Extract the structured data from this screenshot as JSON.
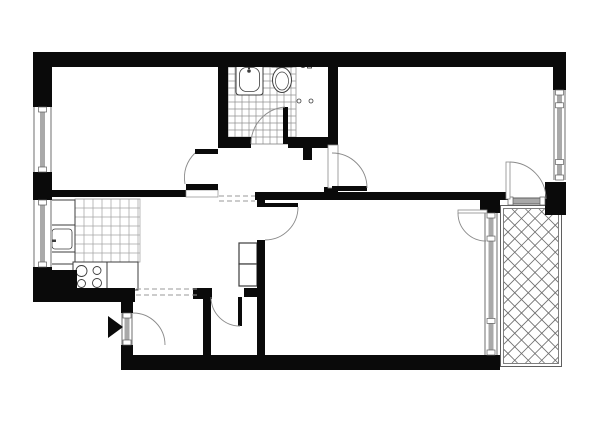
{
  "canvas": {
    "width": 600,
    "height": 424,
    "background": "#ffffff"
  },
  "colors": {
    "wall": "#0a0a0a",
    "glazing": "#a9a9a9",
    "line": "#5f5f5f",
    "arc": "#8a8a8a",
    "tile": "#a5a5a5",
    "bathtile": "#909090",
    "hatch": "#6e6e6e",
    "dash": "#9a9a9a",
    "fixture": "#3d3d3d",
    "white": "#ffffff"
  },
  "rooms": [
    {
      "name": "room-top-left-area",
      "x": 52,
      "y": 67,
      "w": 166,
      "h": 123
    },
    {
      "name": "bedroom-area",
      "x": 338,
      "y": 67,
      "w": 215,
      "h": 125
    },
    {
      "name": "bathroom-area",
      "x": 228,
      "y": 67,
      "w": 100,
      "h": 70
    },
    {
      "name": "kitchen-area",
      "x": 48,
      "y": 197,
      "w": 92,
      "h": 93
    },
    {
      "name": "corridor-area",
      "x": 140,
      "y": 197,
      "w": 117,
      "h": 91
    },
    {
      "name": "living-room-area",
      "x": 265,
      "y": 200,
      "w": 220,
      "h": 155
    },
    {
      "name": "entry-hall-area",
      "x": 133,
      "y": 297,
      "w": 70,
      "h": 58
    },
    {
      "name": "storage-room-area",
      "x": 211,
      "y": 297,
      "w": 46,
      "h": 58
    },
    {
      "name": "balcony-area",
      "x": 500,
      "y": 205,
      "w": 62,
      "h": 162
    }
  ],
  "shapes": [
    {
      "name": "kitchen-floor-tiles",
      "type": "grid",
      "x": 75,
      "y": 199,
      "w": 65,
      "h": 63,
      "cell": 9,
      "stroke": "tile",
      "sw": 0.75
    },
    {
      "name": "bathroom-floor-tiles",
      "type": "grid",
      "x": 228,
      "y": 67,
      "w": 68,
      "h": 77,
      "cell": 7,
      "stroke": "bathtile",
      "sw": 0.7
    },
    {
      "name": "balcony-border-outer",
      "type": "rectline",
      "x": 500.5,
      "y": 205.5,
      "w": 61,
      "h": 161,
      "stroke": "line",
      "sw": 1
    },
    {
      "name": "balcony-border-inner",
      "type": "rectline",
      "x": 503.5,
      "y": 208.5,
      "w": 55,
      "h": 155,
      "stroke": "line",
      "sw": 0.8
    },
    {
      "name": "balcony-decking-hatch",
      "type": "hatch",
      "x": 504,
      "y": 209,
      "w": 54,
      "h": 154,
      "spacing": 13.5,
      "stroke": "hatch",
      "sw": 0.8
    },
    {
      "name": "bathtub-outer",
      "type": "rect",
      "x": 236,
      "y": 64,
      "w": 27,
      "h": 31,
      "rx": 3,
      "fill": "white",
      "stroke": "fixture",
      "sw": 1
    },
    {
      "name": "bathtub-inner",
      "type": "rect",
      "x": 239.5,
      "y": 67.5,
      "w": 20,
      "h": 24,
      "rx": 7,
      "fill": "none",
      "stroke": "fixture",
      "sw": 0.8
    },
    {
      "name": "bathtub-faucet-icon",
      "type": "circle",
      "cx": 249,
      "cy": 71,
      "r": 1.8,
      "fill": "fixture",
      "stroke": "none"
    },
    {
      "name": "bathtub-faucet-stem",
      "type": "rect",
      "x": 248,
      "y": 64,
      "w": 2,
      "h": 5,
      "fill": "fixture",
      "stroke": "none"
    },
    {
      "name": "toilet-tank",
      "type": "rect",
      "x": 272,
      "y": 61,
      "w": 20,
      "h": 6,
      "fill": "white",
      "stroke": "fixture",
      "sw": 1
    },
    {
      "name": "toilet-bowl",
      "type": "ellipse",
      "cx": 282,
      "cy": 80,
      "rx": 9.5,
      "ry": 12.5,
      "fill": "white",
      "stroke": "fixture",
      "sw": 1
    },
    {
      "name": "toilet-bowl-inner",
      "type": "ellipse",
      "cx": 282,
      "cy": 81,
      "rx": 6.5,
      "ry": 9,
      "fill": "none",
      "stroke": "fixture",
      "sw": 0.7
    },
    {
      "name": "utility-tap-icon",
      "type": "circle",
      "cx": 303,
      "cy": 65,
      "r": 2.6,
      "fill": "none",
      "stroke": "fixture",
      "sw": 0.9
    },
    {
      "name": "utility-valve-icon",
      "type": "rect",
      "x": 307.5,
      "y": 59,
      "w": 4,
      "h": 9,
      "fill": "white",
      "stroke": "fixture",
      "sw": 0.9
    },
    {
      "name": "hookup-point-left",
      "type": "circle",
      "cx": 299,
      "cy": 101,
      "r": 2,
      "fill": "none",
      "stroke": "fixture",
      "sw": 0.8
    },
    {
      "name": "hookup-point-right",
      "type": "circle",
      "cx": 311,
      "cy": 101,
      "r": 2,
      "fill": "none",
      "stroke": "fixture",
      "sw": 0.8
    },
    {
      "name": "bathroom-zone-divider",
      "type": "line",
      "x1": 296,
      "y1": 67,
      "x2": 296,
      "y2": 142,
      "stroke": "tile",
      "sw": 0.8
    },
    {
      "name": "kitchen-cabinet",
      "type": "rect",
      "x": 48,
      "y": 200,
      "w": 27,
      "h": 25,
      "fill": "white",
      "stroke": "fixture",
      "sw": 1
    },
    {
      "name": "kitchen-sink-outer",
      "type": "rect",
      "x": 48,
      "y": 225,
      "w": 27,
      "h": 27,
      "fill": "white",
      "stroke": "fixture",
      "sw": 1
    },
    {
      "name": "kitchen-sink-basin",
      "type": "rect",
      "x": 52,
      "y": 229,
      "w": 20,
      "h": 20,
      "rx": 3,
      "fill": "none",
      "stroke": "fixture",
      "sw": 0.8
    },
    {
      "name": "kitchen-faucet-bar",
      "type": "rect",
      "x": 45.5,
      "y": 236.5,
      "w": 3,
      "h": 8,
      "fill": "fixture",
      "stroke": "none"
    },
    {
      "name": "kitchen-faucet-stem",
      "type": "rect",
      "x": 48,
      "y": 239.5,
      "w": 8,
      "h": 2.5,
      "fill": "fixture",
      "stroke": "none"
    },
    {
      "name": "kitchen-counter",
      "type": "rect",
      "x": 48,
      "y": 252,
      "w": 27,
      "h": 12,
      "fill": "white",
      "stroke": "fixture",
      "sw": 1
    },
    {
      "name": "stove-unit",
      "type": "rect",
      "x": 73,
      "y": 262,
      "w": 34,
      "h": 28,
      "fill": "white",
      "stroke": "fixture",
      "sw": 1
    },
    {
      "name": "stove-burner-1",
      "type": "circle",
      "cx": 81.5,
      "cy": 271,
      "r": 5.5,
      "fill": "none",
      "stroke": "fixture",
      "sw": 0.9
    },
    {
      "name": "stove-burner-2",
      "type": "circle",
      "cx": 97,
      "cy": 270.5,
      "r": 4,
      "fill": "none",
      "stroke": "fixture",
      "sw": 0.9
    },
    {
      "name": "stove-burner-3",
      "type": "circle",
      "cx": 81.5,
      "cy": 283.5,
      "r": 4,
      "fill": "none",
      "stroke": "fixture",
      "sw": 0.9
    },
    {
      "name": "stove-burner-4",
      "type": "circle",
      "cx": 97,
      "cy": 283,
      "r": 4.5,
      "fill": "none",
      "stroke": "fixture",
      "sw": 0.9
    },
    {
      "name": "kitchen-counter-2",
      "type": "rect",
      "x": 107,
      "y": 262,
      "w": 31,
      "h": 28,
      "fill": "white",
      "stroke": "fixture",
      "sw": 1
    },
    {
      "name": "hall-cabinet-upper",
      "type": "rect",
      "x": 239,
      "y": 243,
      "w": 18,
      "h": 21,
      "fill": "white",
      "stroke": "fixture",
      "sw": 1.2
    },
    {
      "name": "hall-cabinet-lower",
      "type": "rect",
      "x": 239,
      "y": 264,
      "w": 18,
      "h": 22,
      "fill": "white",
      "stroke": "fixture",
      "sw": 1.2
    },
    {
      "name": "wall-top",
      "type": "rect",
      "x": 33,
      "y": 52,
      "w": 533,
      "h": 15,
      "fill": "wall"
    },
    {
      "name": "wall-left-upper",
      "type": "rect",
      "x": 33,
      "y": 52,
      "w": 19,
      "h": 55,
      "fill": "wall"
    },
    {
      "name": "wall-left-mid",
      "type": "rect",
      "x": 33,
      "y": 172,
      "w": 19,
      "h": 28,
      "fill": "wall"
    },
    {
      "name": "wall-left-lower",
      "type": "rect",
      "x": 33,
      "y": 267,
      "w": 19,
      "h": 35,
      "fill": "wall"
    },
    {
      "name": "wall-kitchen-corner-block",
      "type": "rect",
      "x": 33,
      "y": 270,
      "w": 44,
      "h": 32,
      "fill": "wall"
    },
    {
      "name": "wall-kitchen-bottom",
      "type": "rect",
      "x": 33,
      "y": 288,
      "w": 102,
      "h": 14,
      "fill": "wall"
    },
    {
      "name": "wall-room1-bottom",
      "type": "rect",
      "x": 33,
      "y": 190,
      "w": 153,
      "h": 7,
      "fill": "wall"
    },
    {
      "name": "wall-room1-bathroom",
      "type": "rect",
      "x": 218,
      "y": 67,
      "w": 10,
      "h": 81,
      "fill": "wall"
    },
    {
      "name": "wall-bathroom-bottom-left",
      "type": "rect",
      "x": 228,
      "y": 137,
      "w": 23,
      "h": 11,
      "fill": "wall"
    },
    {
      "name": "wall-bathroom-bottom-right",
      "type": "rect",
      "x": 288,
      "y": 137,
      "w": 40,
      "h": 11,
      "fill": "wall"
    },
    {
      "name": "wall-hall-stub",
      "type": "rect",
      "x": 303,
      "y": 148,
      "w": 9,
      "h": 12,
      "fill": "wall"
    },
    {
      "name": "wall-bathroom-bedroom",
      "type": "rect",
      "x": 328,
      "y": 67,
      "w": 10,
      "h": 81,
      "fill": "wall"
    },
    {
      "name": "wall-living-north",
      "type": "rect",
      "x": 255,
      "y": 192,
      "w": 253,
      "h": 8,
      "fill": "wall"
    },
    {
      "name": "wall-step-block",
      "type": "rect",
      "x": 324,
      "y": 187,
      "w": 14,
      "h": 13,
      "fill": "wall"
    },
    {
      "name": "wall-balcony-junction",
      "type": "rect",
      "x": 480,
      "y": 197,
      "w": 20,
      "h": 16,
      "fill": "wall"
    },
    {
      "name": "wall-living-west",
      "type": "rect",
      "x": 257,
      "y": 240,
      "w": 8,
      "h": 120,
      "fill": "wall"
    },
    {
      "name": "wall-living-west-stub",
      "type": "rect",
      "x": 257,
      "y": 200,
      "w": 8,
      "h": 7,
      "fill": "wall"
    },
    {
      "name": "wall-hall-bottom-left",
      "type": "rect",
      "x": 193,
      "y": 288,
      "w": 19,
      "h": 11,
      "fill": "wall"
    },
    {
      "name": "wall-hall-bottom-right",
      "type": "rect",
      "x": 244,
      "y": 288,
      "w": 21,
      "h": 9,
      "fill": "wall"
    },
    {
      "name": "wall-entry-upper",
      "type": "rect",
      "x": 121,
      "y": 288,
      "w": 12,
      "h": 25,
      "fill": "wall"
    },
    {
      "name": "wall-entry-lower",
      "type": "rect",
      "x": 121,
      "y": 345,
      "w": 12,
      "h": 25,
      "fill": "wall"
    },
    {
      "name": "wall-storage-west",
      "type": "rect",
      "x": 203,
      "y": 297,
      "w": 8,
      "h": 63,
      "fill": "wall"
    },
    {
      "name": "wall-bottom",
      "type": "rect",
      "x": 121,
      "y": 355,
      "w": 379,
      "h": 15,
      "fill": "wall"
    },
    {
      "name": "wall-right-upper",
      "type": "rect",
      "x": 553,
      "y": 52,
      "w": 13,
      "h": 38,
      "fill": "wall"
    },
    {
      "name": "wall-right-block",
      "type": "rect",
      "x": 545,
      "y": 182,
      "w": 21,
      "h": 33,
      "fill": "wall"
    },
    {
      "name": "bedroom-door-frame",
      "type": "rect",
      "x": 328,
      "y": 145,
      "w": 10,
      "h": 43,
      "fill": "white",
      "stroke": "arc",
      "sw": 0.8
    },
    {
      "name": "room1-door-frame",
      "type": "rect",
      "x": 186,
      "y": 190,
      "w": 32,
      "h": 7,
      "fill": "white",
      "stroke": "arc",
      "sw": 0.7
    },
    {
      "name": "window-room1-left",
      "type": "window",
      "x": 33,
      "y": 107,
      "w": 19,
      "h": 65,
      "orient": "v"
    },
    {
      "name": "window-kitchen-left",
      "type": "window",
      "x": 33,
      "y": 200,
      "w": 19,
      "h": 67,
      "orient": "v"
    },
    {
      "name": "window-bedroom-right",
      "type": "window",
      "x": 553,
      "y": 90,
      "w": 13,
      "h": 90,
      "orient": "v",
      "mids": [
        0.17,
        0.8
      ]
    },
    {
      "name": "window-wall-living-balcony",
      "type": "window",
      "x": 484,
      "y": 213,
      "w": 14,
      "h": 142,
      "orient": "v",
      "mids": [
        0.18,
        0.76
      ]
    },
    {
      "name": "glazed-door-bedroom-balcony",
      "type": "window",
      "x": 508,
      "y": 197,
      "w": 37,
      "h": 8,
      "orient": "h"
    },
    {
      "name": "entrance-door-panel",
      "type": "window",
      "x": 121,
      "y": 313,
      "w": 12,
      "h": 32,
      "orient": "v"
    },
    {
      "name": "door-room1",
      "type": "door",
      "leaves": [
        {
          "x": 195,
          "y": 149,
          "w": 23,
          "h": 5,
          "fill": "wall"
        },
        {
          "x": 186,
          "y": 184,
          "w": 32,
          "h": 6,
          "fill": "wall"
        }
      ],
      "arc": "M 195 153 Q 182 166 185 184"
    },
    {
      "name": "door-bathroom",
      "type": "door",
      "leaves": [
        {
          "x": 283,
          "y": 107,
          "w": 5,
          "h": 37,
          "fill": "wall"
        }
      ],
      "arc": "M 251 144 A 37 37 0 0 1 285 107"
    },
    {
      "name": "door-bedroom",
      "type": "door",
      "leaves": [
        {
          "x": 332,
          "y": 186,
          "w": 35,
          "h": 5,
          "fill": "wall"
        }
      ],
      "arc": "M 332 153 A 35 35 0 0 1 367 188"
    },
    {
      "name": "door-living-room",
      "type": "door",
      "leaves": [
        {
          "x": 265,
          "y": 203,
          "w": 33,
          "h": 4,
          "fill": "wall"
        }
      ],
      "arc": "M 298 207 A 33 33 0 0 1 265 240"
    },
    {
      "name": "door-storage",
      "type": "door",
      "leaves": [
        {
          "x": 238,
          "y": 297,
          "w": 4,
          "h": 29,
          "fill": "wall"
        }
      ],
      "arc": "M 211 297 A 29 29 0 0 0 240 326"
    },
    {
      "name": "door-entrance-swing",
      "type": "door",
      "leaves": [],
      "arc": "M 133 313 A 32 32 0 0 1 165 345"
    },
    {
      "name": "door-living-balcony",
      "type": "door",
      "leaves": [
        {
          "x": 458,
          "y": 210,
          "w": 29,
          "h": 3,
          "fill": "white",
          "stroke": "arc",
          "sw": 0.8
        }
      ],
      "arc": "M 458 213 A 28 28 0 0 0 486 241"
    },
    {
      "name": "door-bedroom-balcony",
      "type": "door",
      "leaves": [
        {
          "x": 506,
          "y": 162,
          "w": 4,
          "h": 37,
          "fill": "white",
          "stroke": "arc",
          "sw": 0.8
        }
      ],
      "arc": "M 510 162 A 37 37 0 0 1 546 199"
    },
    {
      "name": "dashed-beam-entry-1",
      "type": "line",
      "x1": 136,
      "y1": 289,
      "x2": 200,
      "y2": 289,
      "stroke": "dash",
      "sw": 1,
      "dash": "5,3"
    },
    {
      "name": "dashed-beam-entry-2",
      "type": "line",
      "x1": 136,
      "y1": 295,
      "x2": 200,
      "y2": 295,
      "stroke": "dash",
      "sw": 1,
      "dash": "5,3"
    },
    {
      "name": "dashed-beam-corridor-1",
      "type": "line",
      "x1": 219,
      "y1": 196,
      "x2": 255,
      "y2": 196,
      "stroke": "dash",
      "sw": 1,
      "dash": "5,3"
    },
    {
      "name": "dashed-beam-corridor-2",
      "type": "line",
      "x1": 219,
      "y1": 201,
      "x2": 255,
      "y2": 201,
      "stroke": "dash",
      "sw": 1,
      "dash": "5,3"
    },
    {
      "name": "entrance-arrow-icon",
      "type": "polygon",
      "points": "108,316 108,338 123,327",
      "fill": "wall"
    }
  ]
}
